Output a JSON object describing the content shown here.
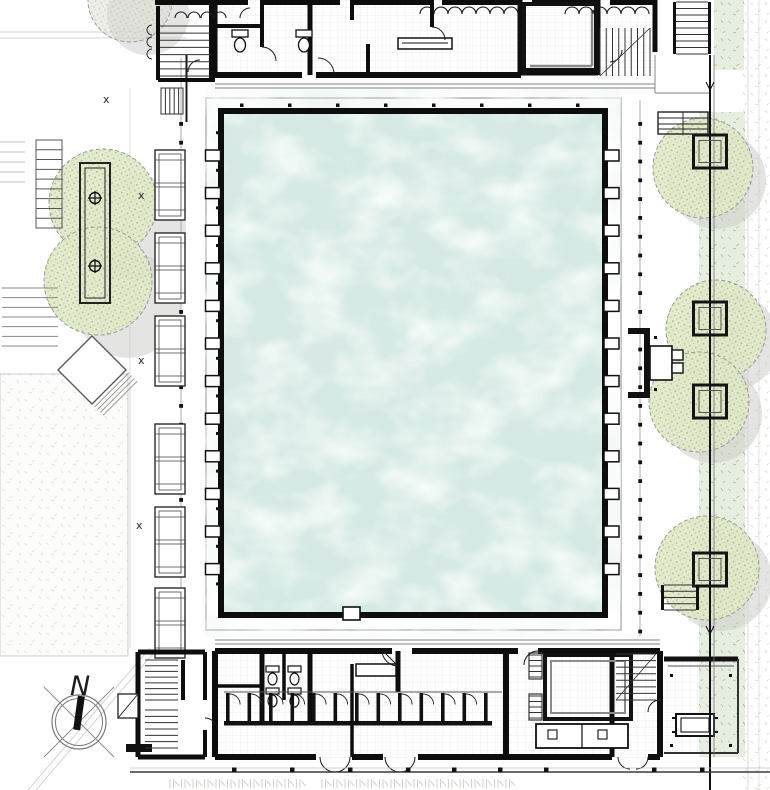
{
  "compass": {
    "north_label": "N"
  },
  "markers": {
    "cross": "x"
  },
  "counts": {
    "pool_ladders_per_side": 12,
    "benches_west": 6,
    "pavilions_east": 4,
    "trees_total": 7,
    "changing_stalls_south": 13,
    "toilets_north": 2,
    "toilets_south": 4
  },
  "palette": {
    "paper": "#ffffff",
    "wall": "#0d0d0d",
    "water": "#d6eae5",
    "water_light": "#f1faf7",
    "water_shadow": "#aecbc4",
    "deck_line": "#b5b5b3",
    "greenery": "#e6efdf",
    "foliage": "#e0e9ca",
    "foliage_speckle": "#9fb573",
    "tree_shadow": "#c9c9c7"
  }
}
